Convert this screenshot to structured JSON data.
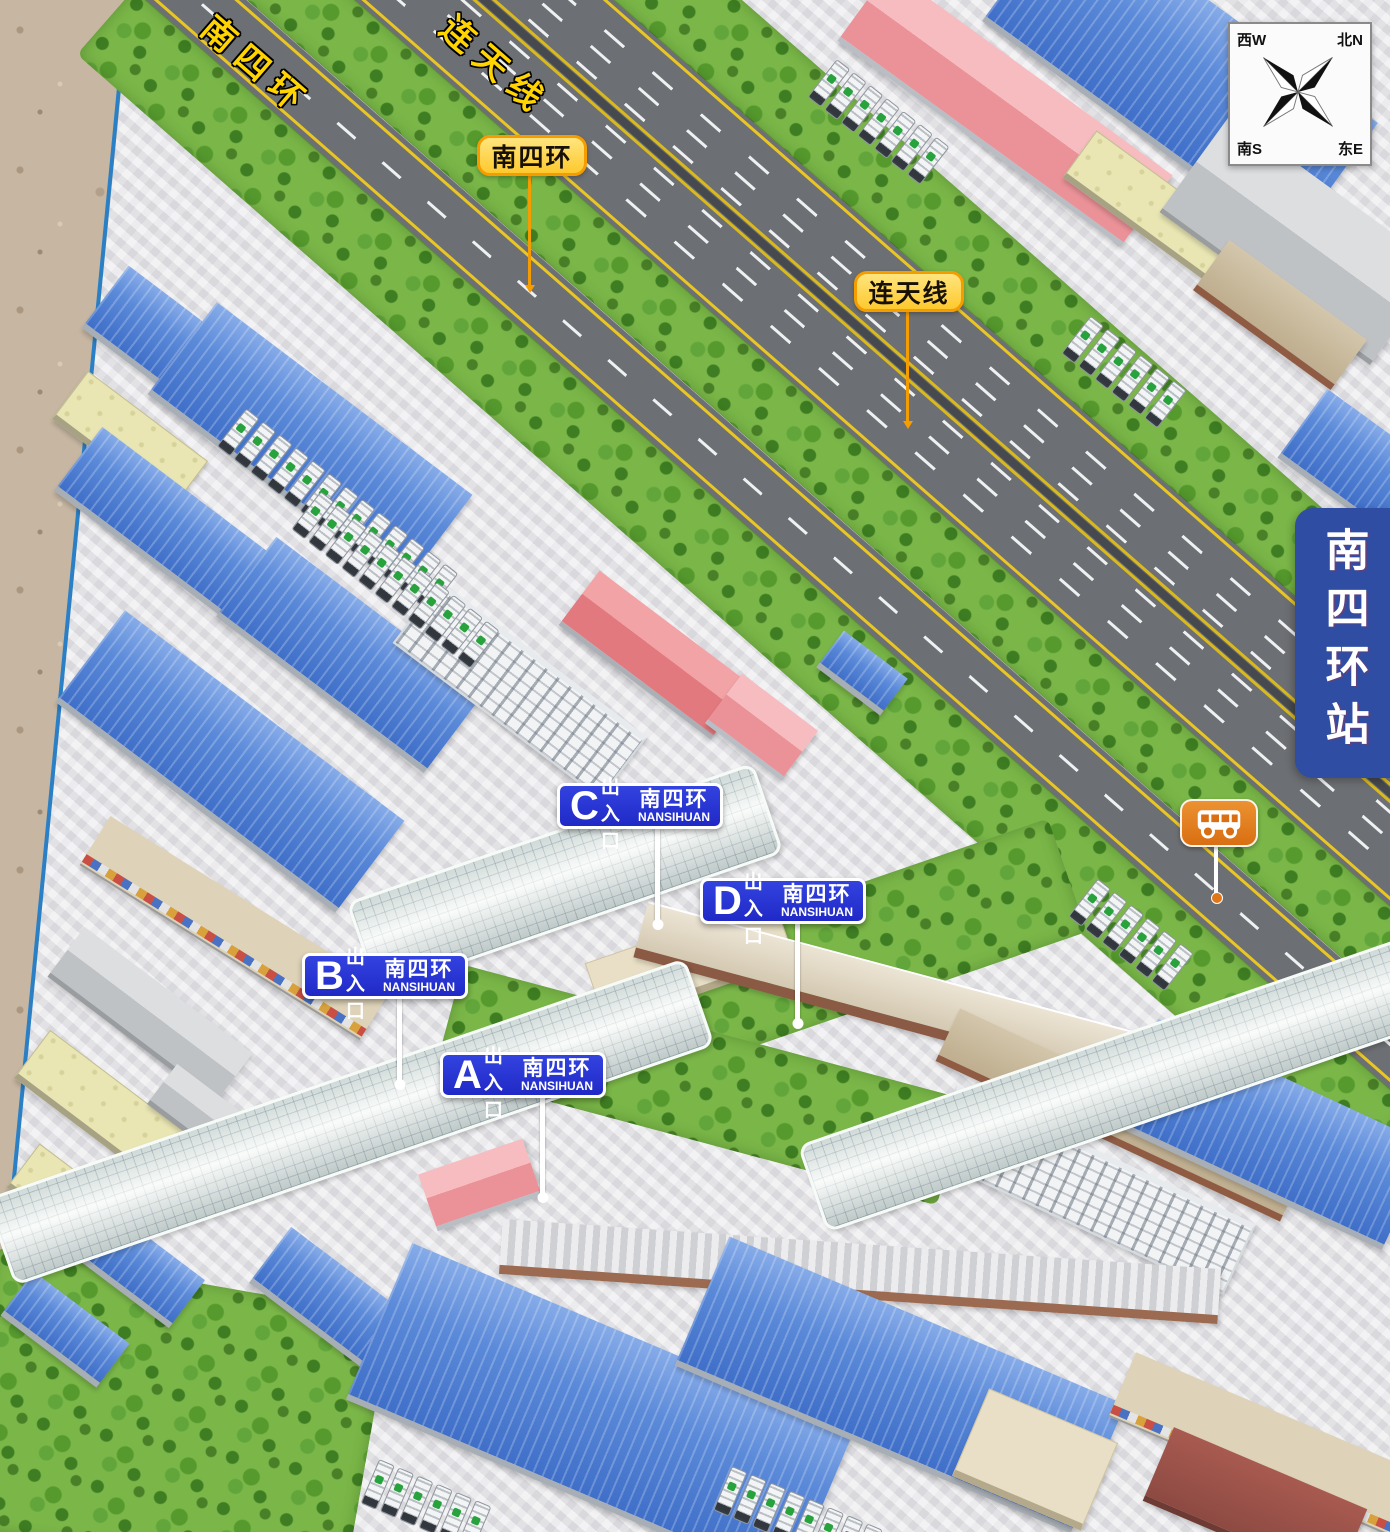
{
  "station_banner": "南四环站",
  "compass": {
    "nw": "西W",
    "ne": "北N",
    "sw": "南S",
    "se": "东E"
  },
  "roads": {
    "label_nansihuan": "南四环",
    "label_liantian": "连天线"
  },
  "badges": {
    "nansihuan": "南四环",
    "liantian": "连天线"
  },
  "entrances": [
    {
      "letter": "A",
      "gate": "出入口",
      "road": "南四环",
      "road_en": "NANSIHUAN"
    },
    {
      "letter": "B",
      "gate": "出入口",
      "road": "南四环",
      "road_en": "NANSIHUAN"
    },
    {
      "letter": "C",
      "gate": "出入口",
      "road": "南四环",
      "road_en": "NANSIHUAN"
    },
    {
      "letter": "D",
      "gate": "出入口",
      "road": "南四环",
      "road_en": "NANSIHUAN"
    }
  ],
  "icons": {
    "bus_stop": "bus-icon",
    "compass": "compass-rose-icon"
  },
  "colors": {
    "entrance_sign_blue": "#2431D0",
    "badge_yellow": "#FFD23F",
    "badge_border_orange": "#F59A00",
    "banner_blue": "#2E4DA3",
    "bus_stop_orange": "#E0761A",
    "road_label_yellow": "#FFD400",
    "road_gray": "#6C6F73",
    "grass_green": "#7AB648"
  }
}
